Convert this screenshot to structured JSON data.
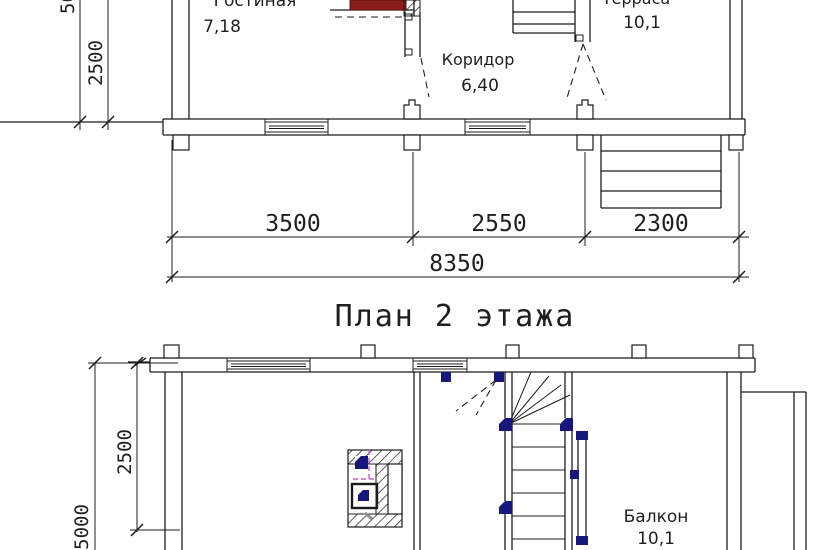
{
  "colors": {
    "line": "#1c1c1c",
    "stove_red": "#8b1d1d",
    "stair_navy": "#16167c",
    "flue_magenta": "#c465c4"
  },
  "floor1": {
    "room_living": {
      "name": "Гостиная",
      "area": "7,18"
    },
    "room_corridor": {
      "name": "Коридор",
      "area": "6,40"
    },
    "room_terrace": {
      "name": "Терраса",
      "area": "10,1"
    },
    "dim_seg1": "3500",
    "dim_seg2": "2550",
    "dim_seg3": "2300",
    "dim_total": "8350",
    "dim_left_inner": "2500",
    "dim_left_outer": "5000"
  },
  "floor2": {
    "title": "План 2 этажа",
    "room_balcony": {
      "name": "Балкон",
      "area": "10,1"
    },
    "dim_left_inner": "2500",
    "dim_left_outer": "5000"
  }
}
